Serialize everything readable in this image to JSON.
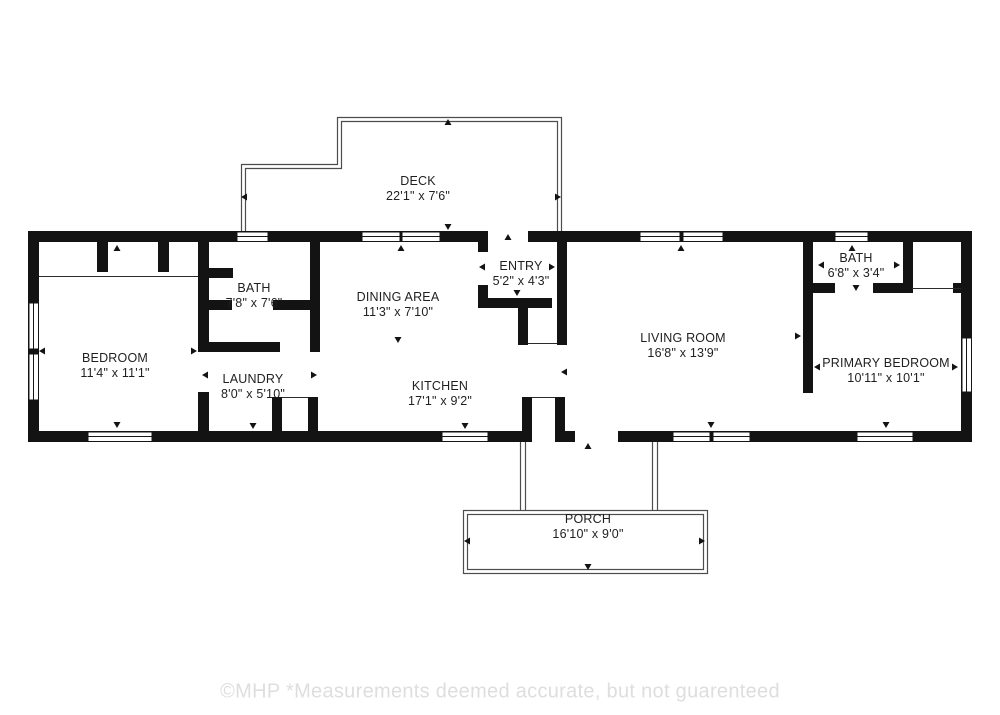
{
  "rooms": [
    {
      "id": "deck",
      "name": "DECK",
      "dims": "22'1\" x 7'6\""
    },
    {
      "id": "bedroom",
      "name": "BEDROOM",
      "dims": "11'4\" x 11'1\""
    },
    {
      "id": "bath-left",
      "name": "BATH",
      "dims": "7'8\" x 7'6\""
    },
    {
      "id": "dining",
      "name": "DINING AREA",
      "dims": "11'3\" x 7'10\""
    },
    {
      "id": "entry",
      "name": "ENTRY",
      "dims": "5'2\" x 4'3\""
    },
    {
      "id": "laundry",
      "name": "LAUNDRY",
      "dims": "8'0\" x 5'10\""
    },
    {
      "id": "kitchen",
      "name": "KITCHEN",
      "dims": "17'1\" x 9'2\""
    },
    {
      "id": "living",
      "name": "LIVING ROOM",
      "dims": "16'8\" x 13'9\""
    },
    {
      "id": "bath-right",
      "name": "BATH",
      "dims": "6'8\" x 3'4\""
    },
    {
      "id": "primary",
      "name": "PRIMARY BEDROOM",
      "dims": "10'11\" x 10'1\""
    },
    {
      "id": "porch",
      "name": "PORCH",
      "dims": "16'10\" x 9'0\""
    }
  ],
  "footer": {
    "text": "©MHP  *Measurements deemed accurate, but not guarenteed"
  },
  "colors": {
    "background": "#ffffff",
    "wall": "#131313",
    "deck_porch_outline": "#4d4d4d",
    "label_text": "#1f1f1f",
    "footer_text": "#dedede"
  }
}
